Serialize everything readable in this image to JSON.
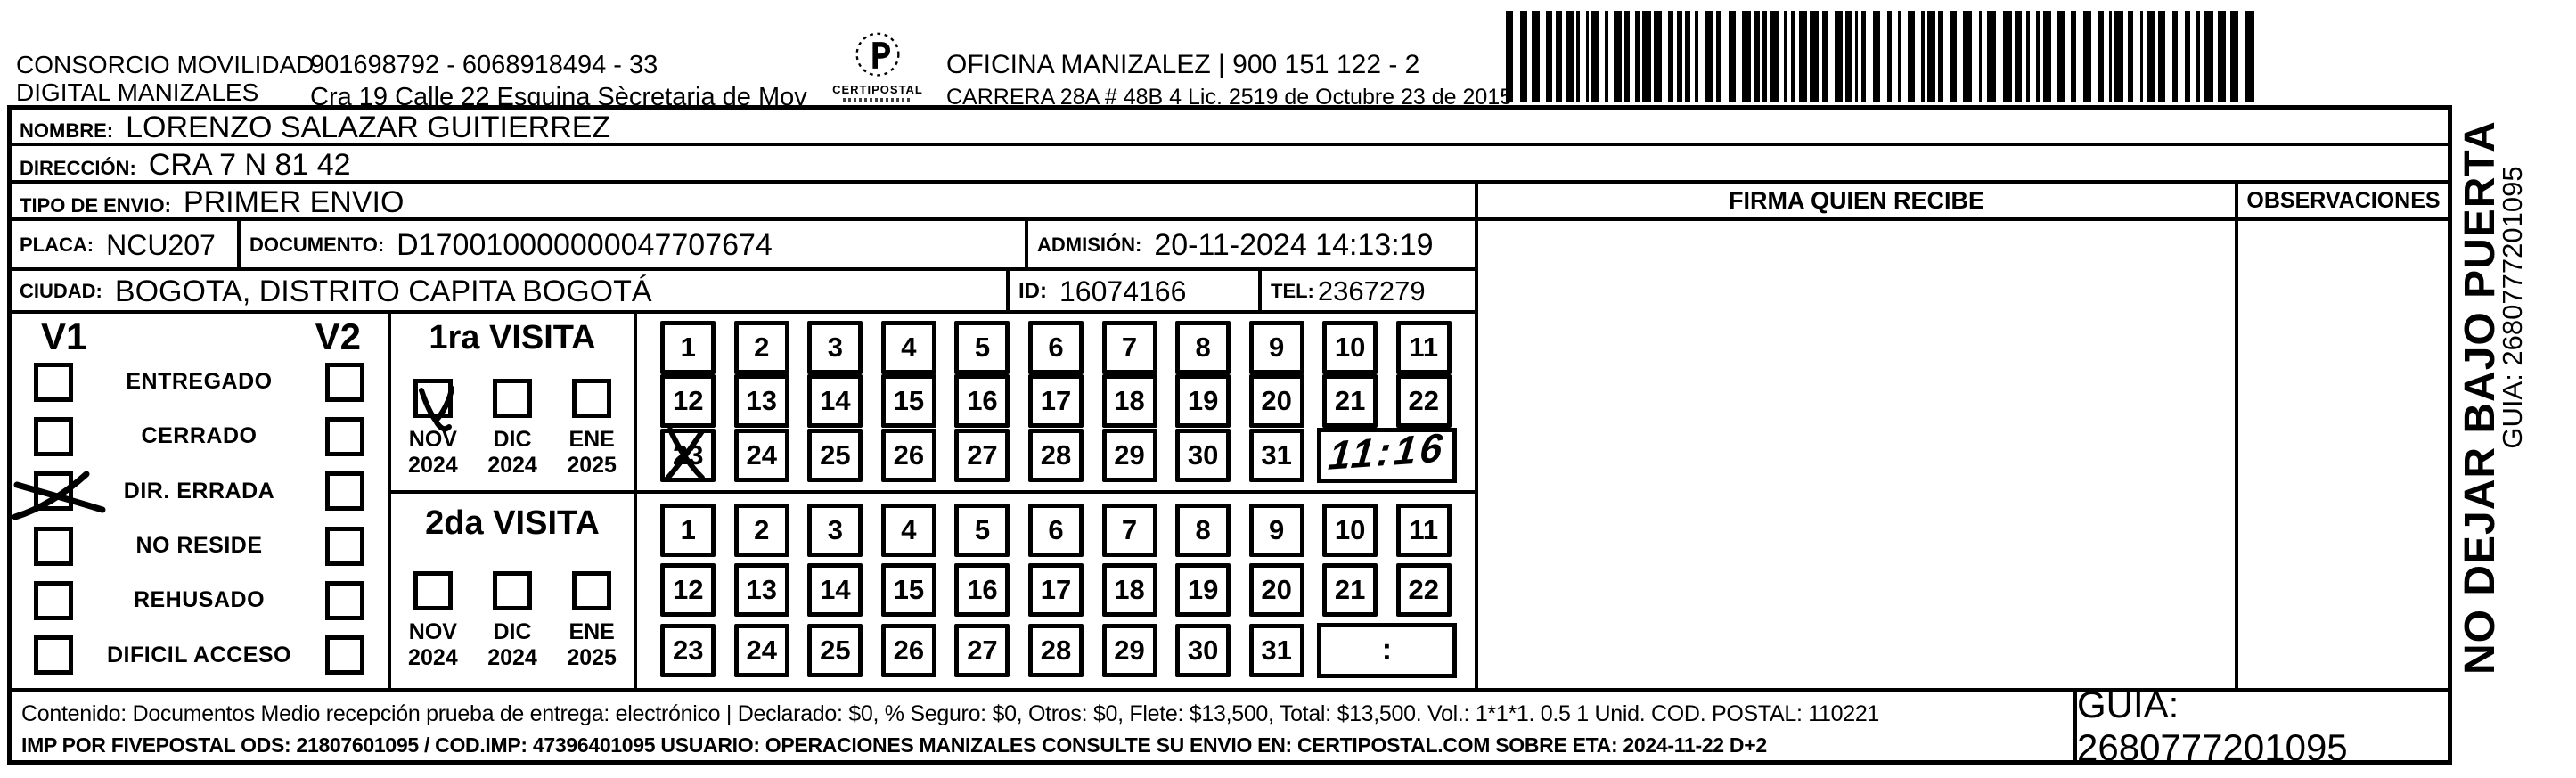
{
  "header": {
    "company_line1": "CONSORCIO MOVILIDAD",
    "company_line2": "DIGITAL MANIZALES",
    "registry_line": "901698792 - 6068918494 - 33",
    "address_line": "Cra 19 Calle 22 Esquina Sècretaria de Mov",
    "logo_text": "CERTIPOSTAL",
    "office_line": "OFICINA MANIZALEZ | 900 151 122 - 2",
    "license_line": "CARRERA 28A #  48B 4 Lic. 2519 de Octubre 23 de 2015"
  },
  "fields": {
    "nombre_label": "NOMBRE:",
    "nombre_value": "LORENZO SALAZAR GUITIERREZ",
    "direccion_label": "DIRECCIÓN:",
    "direccion_value": "CRA 7 N 81 42",
    "tipo_envio_label": "TIPO DE ENVIO:",
    "tipo_envio_value": "PRIMER ENVIO",
    "placa_label": "PLACA:",
    "placa_value": "NCU207",
    "documento_label": "DOCUMENTO:",
    "documento_value": "D170010000000047707674",
    "admision_label": "ADMISIÓN:",
    "admision_value": "20-11-2024 14:13:19",
    "ciudad_label": "CIUDAD:",
    "ciudad_value": "BOGOTA, DISTRITO CAPITA BOGOTÁ",
    "id_label": "ID:",
    "id_value": "16074166",
    "tel_label": "TEL:",
    "tel_value": "2367279"
  },
  "right_panel": {
    "firma_header": "FIRMA QUIEN RECIBE",
    "observaciones_header": "OBSERVACIONES"
  },
  "status_panel": {
    "v1_header": "V1",
    "v2_header": "V2",
    "options": [
      {
        "label": "ENTREGADO",
        "v1_checked": false,
        "v2_checked": false
      },
      {
        "label": "CERRADO",
        "v1_checked": false,
        "v2_checked": false
      },
      {
        "label": "DIR. ERRADA",
        "v1_checked": true,
        "v2_checked": false
      },
      {
        "label": "NO RESIDE",
        "v1_checked": false,
        "v2_checked": false
      },
      {
        "label": "REHUSADO",
        "v1_checked": false,
        "v2_checked": false
      },
      {
        "label": "DIFICIL ACCESO",
        "v1_checked": false,
        "v2_checked": false
      }
    ]
  },
  "visita1": {
    "title": "1ra VISITA",
    "months": [
      {
        "month": "NOV",
        "year": "2024",
        "checked": true
      },
      {
        "month": "DIC",
        "year": "2024",
        "checked": false
      },
      {
        "month": "ENE",
        "year": "2025",
        "checked": false
      }
    ],
    "days": [
      1,
      2,
      3,
      4,
      5,
      6,
      7,
      8,
      9,
      10,
      11,
      12,
      13,
      14,
      15,
      16,
      17,
      18,
      19,
      20,
      21,
      22,
      23,
      24,
      25,
      26,
      27,
      28,
      29,
      30,
      31
    ],
    "crossed_day": 23,
    "time_written": "11:16"
  },
  "visita2": {
    "title": "2da VISITA",
    "months": [
      {
        "month": "NOV",
        "year": "2024",
        "checked": false
      },
      {
        "month": "DIC",
        "year": "2024",
        "checked": false
      },
      {
        "month": "ENE",
        "year": "2025",
        "checked": false
      }
    ],
    "days": [
      1,
      2,
      3,
      4,
      5,
      6,
      7,
      8,
      9,
      10,
      11,
      12,
      13,
      14,
      15,
      16,
      17,
      18,
      19,
      20,
      21,
      22,
      23,
      24,
      25,
      26,
      27,
      28,
      29,
      30,
      31
    ],
    "crossed_day": null,
    "time_written": ""
  },
  "time_colon": ":",
  "footer": {
    "line1": "Contenido: Documentos Medio recepción prueba de entrega: electrónico | Declarado: $0, % Seguro: $0, Otros: $0, Flete: $13,500, Total: $13,500. Vol.: 1*1*1. 0.5  1 Unid. COD. POSTAL: 110221",
    "line2": "IMP POR FIVEPOSTAL ODS: 21807601095 / COD.IMP: 47396401095 USUARIO: OPERACIONES MANIZALES CONSULTE SU ENVIO EN: CERTIPOSTAL.COM SOBRE ETA: 2024-11-22 D+2",
    "guia": "GUIA: 2680777201095"
  },
  "side": {
    "warning": "NO DEJAR BAJO PUERTA",
    "guia": "GUIA: 2680777201095"
  },
  "colors": {
    "ink": "#000000",
    "paper": "#ffffff"
  }
}
